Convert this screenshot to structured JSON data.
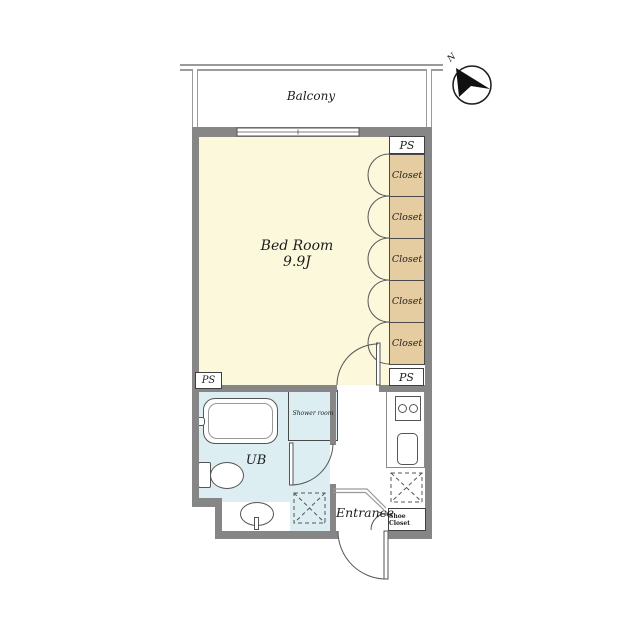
{
  "labels": {
    "balcony": "Balcony",
    "bedroom_name": "Bed Room",
    "bedroom_size": "9.9J",
    "closets": [
      "Closet",
      "Closet",
      "Closet",
      "Closet",
      "Closet"
    ],
    "ps_top": "PS",
    "ps_left": "PS",
    "ps_right": "PS",
    "ub": "UB",
    "shower_room": "Shower room",
    "entrance": "Entrance",
    "shoe_closet": "Shoe Closet",
    "compass_north": "N"
  },
  "colors": {
    "wall": "#868686",
    "bedroom_fill": "#FBF8DC",
    "closet_fill": "#E6CCA1",
    "wet_area_fill": "#DCEEF2",
    "outline": "#555555"
  }
}
